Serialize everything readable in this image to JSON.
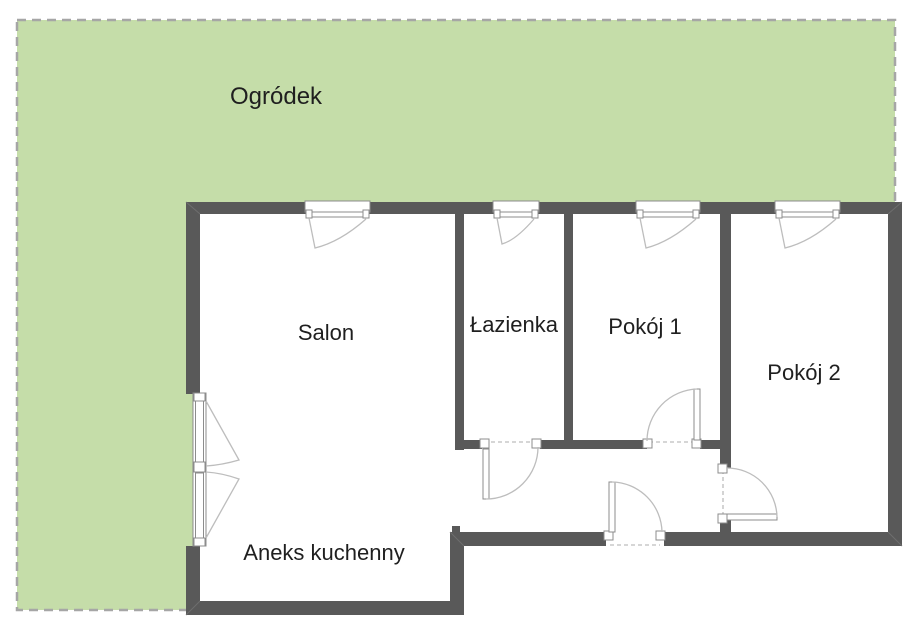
{
  "floor_plan": {
    "garden": {
      "label": "Ogródek"
    },
    "rooms": [
      {
        "id": "salon",
        "label": "Salon"
      },
      {
        "id": "lazienka",
        "label": "Łazienka"
      },
      {
        "id": "pokoj-1",
        "label": "Pokój 1"
      },
      {
        "id": "pokoj-2",
        "label": "Pokój 2"
      },
      {
        "id": "aneks-kuchenny",
        "label": "Aneks kuchenny"
      }
    ],
    "fixtures": {
      "windows": [
        "Salon",
        "Łazienka",
        "Pokój 1",
        "Pokój 2"
      ],
      "doors": [
        "Łazienka",
        "Pokój 1",
        "Pokój 2",
        "entrance"
      ],
      "balcony_door": "double-leaf door on left wall (Salon / Aneks kuchenny)"
    },
    "colors": {
      "garden_fill": "#c5dda9",
      "garden_border": "#a6a6a6",
      "wall": "#595959",
      "floor": "#ffffff",
      "fixture_line": "#bdbdbd",
      "fixture_stroke": "#8c8c8c",
      "opening_dash": "#c9c9c9",
      "label_text": "#1f1f1f"
    }
  }
}
